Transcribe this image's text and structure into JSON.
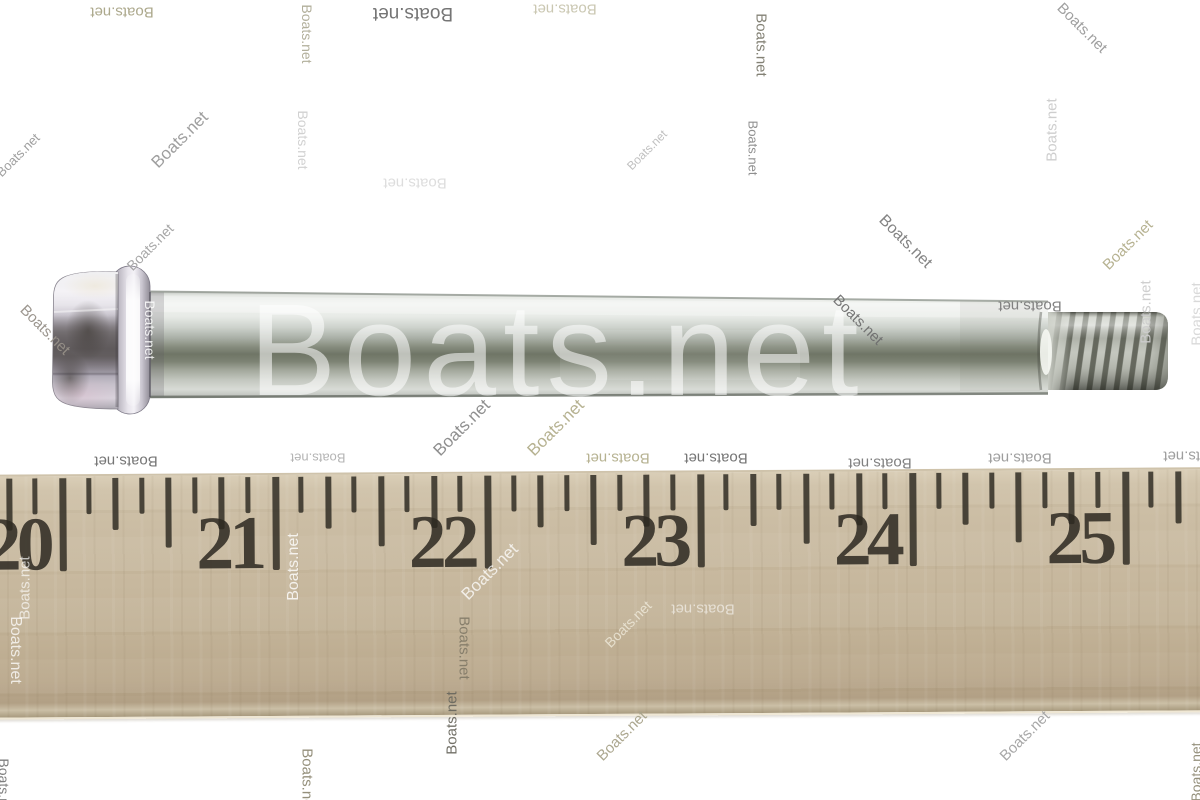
{
  "watermark_text": "Boats.net",
  "large_watermark": {
    "text": "Boats.net",
    "color": "rgba(255,255,255,0.55)"
  },
  "small_watermarks": [
    {
      "x": 122,
      "y": 12,
      "rot": 180,
      "color": "#a8a486",
      "size": 15
    },
    {
      "x": 413,
      "y": 13,
      "rot": 180,
      "color": "#6e6e6e",
      "size": 19
    },
    {
      "x": 565,
      "y": 9,
      "rot": 180,
      "color": "#c8c5ae",
      "size": 15
    },
    {
      "x": 307,
      "y": 34,
      "rot": 90,
      "color": "#aeab96",
      "size": 14
    },
    {
      "x": 761,
      "y": 45,
      "rot": 90,
      "color": "#7d7b6e",
      "size": 15
    },
    {
      "x": 1082,
      "y": 28,
      "rot": 45,
      "color": "#9a9a9a",
      "size": 15
    },
    {
      "x": 180,
      "y": 140,
      "rot": -45,
      "color": "#9a9a9a",
      "size": 17
    },
    {
      "x": 18,
      "y": 155,
      "rot": -45,
      "color": "#9a9a9a",
      "size": 13
    },
    {
      "x": 303,
      "y": 140,
      "rot": 90,
      "color": "#cfcfcf",
      "size": 14
    },
    {
      "x": 415,
      "y": 183,
      "rot": 180,
      "color": "#dcdcdc",
      "size": 15
    },
    {
      "x": 753,
      "y": 148,
      "rot": 90,
      "color": "#8a8a8a",
      "size": 13
    },
    {
      "x": 647,
      "y": 150,
      "rot": -45,
      "color": "#bdbdbd",
      "size": 12
    },
    {
      "x": 1052,
      "y": 130,
      "rot": -90,
      "color": "#cccccc",
      "size": 15
    },
    {
      "x": 150,
      "y": 247,
      "rot": -45,
      "color": "#a3a3a3",
      "size": 14
    },
    {
      "x": 905,
      "y": 242,
      "rot": 45,
      "color": "#7d7d7d",
      "size": 16
    },
    {
      "x": 1128,
      "y": 245,
      "rot": -45,
      "color": "#b3ae8c",
      "size": 15
    },
    {
      "x": 45,
      "y": 330,
      "rot": 45,
      "color": "#969088",
      "size": 15
    },
    {
      "x": 150,
      "y": 330,
      "rot": 90,
      "color": "rgba(255,255,255,0.9)",
      "size": 14
    },
    {
      "x": 858,
      "y": 320,
      "rot": 45,
      "color": "#6f6f6f",
      "size": 15
    },
    {
      "x": 1030,
      "y": 306,
      "rot": 180,
      "color": "#7b7b7b",
      "size": 15
    },
    {
      "x": 1146,
      "y": 312,
      "rot": -90,
      "color": "#cdcdcd",
      "size": 15
    },
    {
      "x": 1197,
      "y": 314,
      "rot": -90,
      "color": "#d8d8d8",
      "size": 15
    },
    {
      "x": 462,
      "y": 428,
      "rot": -45,
      "color": "#8a8a8a",
      "size": 17
    },
    {
      "x": 556,
      "y": 428,
      "rot": -45,
      "color": "#b3ae8c",
      "size": 17
    },
    {
      "x": 618,
      "y": 458,
      "rot": 180,
      "color": "#b3ae8c",
      "size": 15
    },
    {
      "x": 716,
      "y": 458,
      "rot": 180,
      "color": "#6e6e6e",
      "size": 15
    },
    {
      "x": 880,
      "y": 463,
      "rot": 180,
      "color": "#7a7a7a",
      "size": 15
    },
    {
      "x": 1020,
      "y": 458,
      "rot": 180,
      "color": "#999999",
      "size": 15
    },
    {
      "x": 1195,
      "y": 456,
      "rot": 180,
      "color": "#999999",
      "size": 15
    },
    {
      "x": 126,
      "y": 461,
      "rot": 180,
      "color": "#6e6e6e",
      "size": 15
    },
    {
      "x": 318,
      "y": 458,
      "rot": 180,
      "color": "#b0b0b0",
      "size": 13
    },
    {
      "x": 490,
      "y": 572,
      "rot": -45,
      "color": "rgba(255,255,255,0.8)",
      "size": 17
    },
    {
      "x": 294,
      "y": 567,
      "rot": -90,
      "color": "rgba(255,255,255,0.85)",
      "size": 16
    },
    {
      "x": 25,
      "y": 588,
      "rot": -90,
      "color": "rgba(255,255,255,0.7)",
      "size": 15
    },
    {
      "x": 15,
      "y": 650,
      "rot": 90,
      "color": "rgba(255,255,255,0.8)",
      "size": 16
    },
    {
      "x": 464,
      "y": 648,
      "rot": 90,
      "color": "rgba(124,118,100,0.9)",
      "size": 15
    },
    {
      "x": 703,
      "y": 609,
      "rot": 180,
      "color": "rgba(255,255,255,0.6)",
      "size": 15
    },
    {
      "x": 628,
      "y": 624,
      "rot": -45,
      "color": "rgba(250,246,234,0.7)",
      "size": 14
    },
    {
      "x": 622,
      "y": 736,
      "rot": -45,
      "color": "#a8a38a",
      "size": 15
    },
    {
      "x": 1025,
      "y": 736,
      "rot": -45,
      "color": "#a3a3a3",
      "size": 15
    },
    {
      "x": 452,
      "y": 723,
      "rot": -90,
      "color": "#6b695f",
      "size": 15
    },
    {
      "x": 307,
      "y": 780,
      "rot": 90,
      "color": "#8f8a74",
      "size": 15
    },
    {
      "x": 4,
      "y": 788,
      "rot": 90,
      "color": "#787878",
      "size": 14
    },
    {
      "x": 1196,
      "y": 772,
      "rot": -90,
      "color": "#8f8a74",
      "size": 14
    }
  ],
  "ruler": {
    "numbers": [
      "20",
      "21",
      "22",
      "23",
      "24",
      "25"
    ],
    "first_tick_x": 64,
    "number_spacing": 212.5,
    "minor_spacing": 26.5625,
    "wood_color": "#c8ba9f",
    "ink_color": "#2e2a22"
  }
}
